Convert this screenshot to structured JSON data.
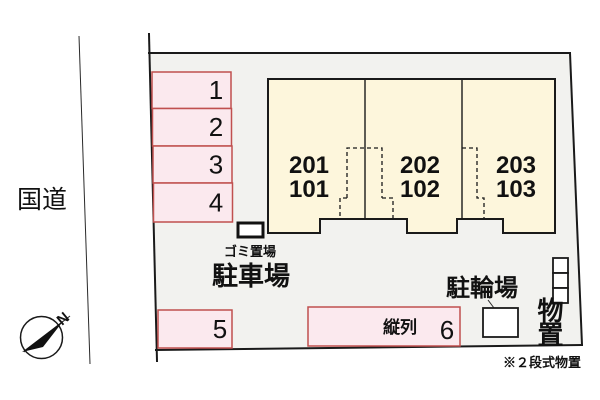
{
  "colors": {
    "site_fill": "#f2f2ef",
    "building_fill": "#fdf6dc",
    "spot_fill": "#fbe9ee",
    "spot_border": "#c0504f",
    "line": "#1a1a1a"
  },
  "surroundings": {
    "road_label": "国道",
    "compass_letter": "N"
  },
  "building": {
    "units": [
      {
        "upper": "201",
        "lower": "101"
      },
      {
        "upper": "202",
        "lower": "102"
      },
      {
        "upper": "203",
        "lower": "103"
      }
    ]
  },
  "parking": {
    "area_label": "駐車場",
    "spots": [
      {
        "number": "1"
      },
      {
        "number": "2"
      },
      {
        "number": "3"
      },
      {
        "number": "4"
      },
      {
        "number": "5"
      }
    ],
    "tandem": {
      "label": "縦列",
      "number": "6"
    }
  },
  "facilities": {
    "garbage_label": "ゴミ置場",
    "bicycle_label": "駐輪場",
    "storage_label": "物置",
    "footnote": "※２段式物置"
  }
}
